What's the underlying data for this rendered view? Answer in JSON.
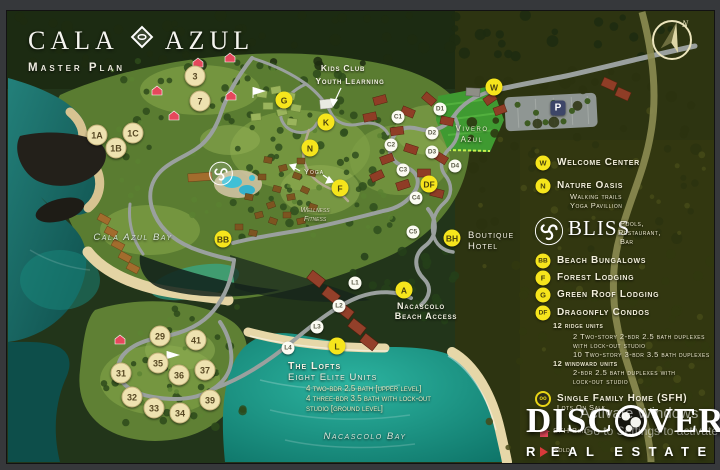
{
  "branding": {
    "name_part1": "CALA",
    "name_part2": "AZUL",
    "subtitle": "Master Plan"
  },
  "compass": {
    "north_label": "N"
  },
  "map_labels": {
    "kids_club_line1": "Kids Club",
    "kids_club_line2": "Youth Learning",
    "vivero_line1": "Vivero",
    "vivero_line2": "Azul",
    "yoga": "Yoga",
    "wellness_line1": "Wellness",
    "wellness_line2": "Fitness",
    "boutique_line1": "Boutique",
    "boutique_line2": "Hotel",
    "beach_access_line1": "Nacascolo",
    "beach_access_line2": "Beach Access",
    "cala_azul_bay": "Cala Azul Bay",
    "nacascolo_bay": "Nacascolo Bay"
  },
  "lofts": {
    "title": "The Lofts",
    "subtitle": "Eight Elite Units",
    "detail_line1": "4 two-bdr 2.5 bath [upper level]",
    "detail_line2": "4 three-bdr 3.5 bath with lock-out",
    "detail_line3": "studio [ground level]"
  },
  "markers": [
    {
      "label": "3",
      "kind": "tan",
      "x": 195,
      "y": 76
    },
    {
      "label": "7",
      "kind": "tan",
      "x": 200,
      "y": 101
    },
    {
      "label": "1A",
      "kind": "tan",
      "x": 97,
      "y": 135
    },
    {
      "label": "1C",
      "kind": "tan",
      "x": 133,
      "y": 133
    },
    {
      "label": "1B",
      "kind": "tan",
      "x": 116,
      "y": 148
    },
    {
      "label": "29",
      "kind": "tan",
      "x": 160,
      "y": 336
    },
    {
      "label": "41",
      "kind": "tan",
      "x": 196,
      "y": 340
    },
    {
      "label": "35",
      "kind": "tan",
      "x": 158,
      "y": 363
    },
    {
      "label": "31",
      "kind": "tan",
      "x": 121,
      "y": 373
    },
    {
      "label": "36",
      "kind": "tan",
      "x": 179,
      "y": 375
    },
    {
      "label": "37",
      "kind": "tan",
      "x": 205,
      "y": 370
    },
    {
      "label": "32",
      "kind": "tan",
      "x": 132,
      "y": 397
    },
    {
      "label": "39",
      "kind": "tan",
      "x": 210,
      "y": 400
    },
    {
      "label": "33",
      "kind": "tan",
      "x": 154,
      "y": 408
    },
    {
      "label": "34",
      "kind": "tan",
      "x": 180,
      "y": 413
    },
    {
      "label": "G",
      "kind": "yellow",
      "x": 284,
      "y": 100
    },
    {
      "label": "K",
      "kind": "yellow",
      "x": 326,
      "y": 122
    },
    {
      "label": "N",
      "kind": "yellow",
      "x": 310,
      "y": 148
    },
    {
      "label": "F",
      "kind": "yellow",
      "x": 340,
      "y": 188
    },
    {
      "label": "W",
      "kind": "yellow",
      "x": 494,
      "y": 87
    },
    {
      "label": "BB",
      "kind": "yellow",
      "x": 223,
      "y": 239
    },
    {
      "label": "DF",
      "kind": "yellow",
      "x": 429,
      "y": 184
    },
    {
      "label": "BH",
      "kind": "yellow",
      "x": 452,
      "y": 238
    },
    {
      "label": "A",
      "kind": "yellow",
      "x": 404,
      "y": 290
    },
    {
      "label": "L",
      "kind": "yellow",
      "x": 337,
      "y": 346
    },
    {
      "label": "C1",
      "kind": "white",
      "x": 398,
      "y": 117
    },
    {
      "label": "D1",
      "kind": "white",
      "x": 440,
      "y": 109
    },
    {
      "label": "D2",
      "kind": "white",
      "x": 432,
      "y": 133
    },
    {
      "label": "C2",
      "kind": "white",
      "x": 391,
      "y": 145
    },
    {
      "label": "D3",
      "kind": "white",
      "x": 432,
      "y": 152
    },
    {
      "label": "D4",
      "kind": "white",
      "x": 455,
      "y": 166
    },
    {
      "label": "C3",
      "kind": "white",
      "x": 403,
      "y": 170
    },
    {
      "label": "C4",
      "kind": "white",
      "x": 416,
      "y": 198
    },
    {
      "label": "C5",
      "kind": "white",
      "x": 413,
      "y": 232
    },
    {
      "label": "L1",
      "kind": "white",
      "x": 355,
      "y": 283
    },
    {
      "label": "L2",
      "kind": "white",
      "x": 339,
      "y": 306
    },
    {
      "label": "L3",
      "kind": "white",
      "x": 317,
      "y": 327
    },
    {
      "label": "L4",
      "kind": "white",
      "x": 288,
      "y": 348
    },
    {
      "label": "P",
      "kind": "parking",
      "x": 558,
      "y": 108
    }
  ],
  "legend": {
    "welcome": {
      "code": "W",
      "label": "Welcome Center"
    },
    "nature": {
      "code": "N",
      "label": "Nature Oasis",
      "sub1": "Walking trails",
      "sub2": "Yoga Pavillion"
    },
    "bliss": {
      "name": "BLISS",
      "desc1": "Pools,",
      "desc2": "Restaurant,",
      "desc3": "Bar"
    },
    "beach_bungalows": {
      "code": "BB",
      "label": "Beach Bungalows"
    },
    "forest_lodging": {
      "code": "F",
      "label": "Forest Lodging"
    },
    "green_roof": {
      "code": "G",
      "label": "Green Roof Lodging"
    },
    "dragonfly": {
      "code": "DF",
      "label": "Dragonfly Condos",
      "ridge_title": "12 ridge units",
      "ridge_line1": "2 Two-story 2-bdr 2.5 bath duplexes",
      "ridge_line2": "with lock-out studio",
      "ridge_line3": "10 Two-story 3-bdr 3.5 bath duplexes",
      "windward_title": "12 windward units",
      "windward_line1": "2-bdr 2.5 bath duplexes with",
      "windward_line2": "lock-out studio"
    },
    "sfh": {
      "label": "Single Family Home (SFH)",
      "status1": "Lots On Sale",
      "status2": "SFH Built",
      "status3": "Sold"
    }
  },
  "discover_logo": {
    "word_part1": "DISC",
    "word_part2": "VER",
    "line2_part1": "R",
    "line2_part2": "EAL ESTATE"
  },
  "watermark": {
    "line1": "Activate Windows",
    "line2": "Go to Settings to activate"
  },
  "colors": {
    "marker_yellow": "#f6e51c",
    "marker_tan": "#eee2b0",
    "accent_red": "#d93a3a",
    "water_teal": "#14978a"
  }
}
